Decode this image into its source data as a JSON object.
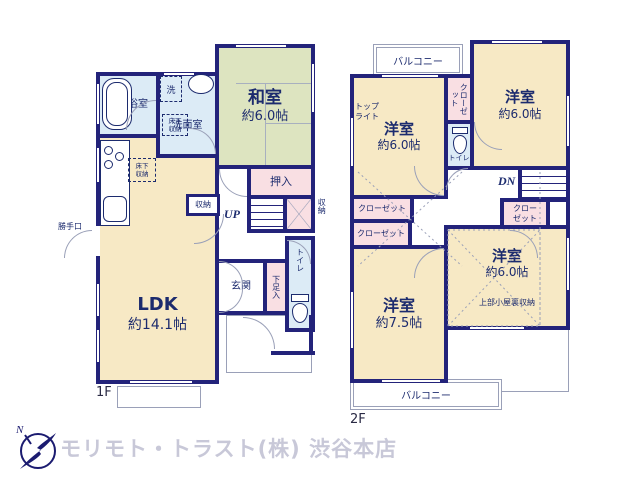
{
  "colors": {
    "wall": "#23237a",
    "ink": "#1c2b6e",
    "cream": "#f7e9c5",
    "green": "#dde4c0",
    "blue": "#dcebf6",
    "pink": "#f9dfe3",
    "line": "#9aa0b8",
    "footer": "#c8c8d8",
    "logo": "#1b1b70"
  },
  "f1": {
    "floor_label": "1F",
    "ldk": {
      "name": "LDK",
      "size": "約14.1帖"
    },
    "washitsu": {
      "name": "和室",
      "size": "約6.0帖"
    },
    "bath": {
      "name": "浴室"
    },
    "laundry": {
      "name": "洗"
    },
    "senmen": {
      "name": "洗面室"
    },
    "underfloor1": {
      "name": "床下収納"
    },
    "underfloor2": {
      "name": "床下収納"
    },
    "oshiire": {
      "name": "押入"
    },
    "stairs": {
      "name": "UP"
    },
    "storage_hall": {
      "name": "収納"
    },
    "storage_side": {
      "name": "収納"
    },
    "genkan": {
      "name": "玄関"
    },
    "shoe": {
      "name": "下足入"
    },
    "toilet": {
      "name": "トイレ"
    },
    "backdoor": {
      "name": "勝手口"
    }
  },
  "f2": {
    "floor_label": "2F",
    "balcony_top": {
      "name": "バルコニー"
    },
    "balcony_bottom": {
      "name": "バルコニー"
    },
    "toplight": {
      "name": "トップライト"
    },
    "room_nw": {
      "name": "洋室",
      "size": "約6.0帖"
    },
    "room_ne": {
      "name": "洋室",
      "size": "約6.0帖"
    },
    "room_sw": {
      "name": "洋室",
      "size": "約7.5帖"
    },
    "room_se": {
      "name": "洋室",
      "size": "約6.0帖",
      "note": "上部小屋裏収納"
    },
    "closet_top": {
      "name": "クローゼット"
    },
    "closet_left1": {
      "name": "クローゼット"
    },
    "closet_left2": {
      "name": "クローゼット"
    },
    "closet_right": {
      "name": "クローゼット"
    },
    "toilet": {
      "name": "トイレ"
    },
    "stairs": {
      "name": "DN"
    }
  },
  "footer": {
    "company": "モリモト・トラスト(株) 渋谷本店",
    "compass_n": "N"
  }
}
